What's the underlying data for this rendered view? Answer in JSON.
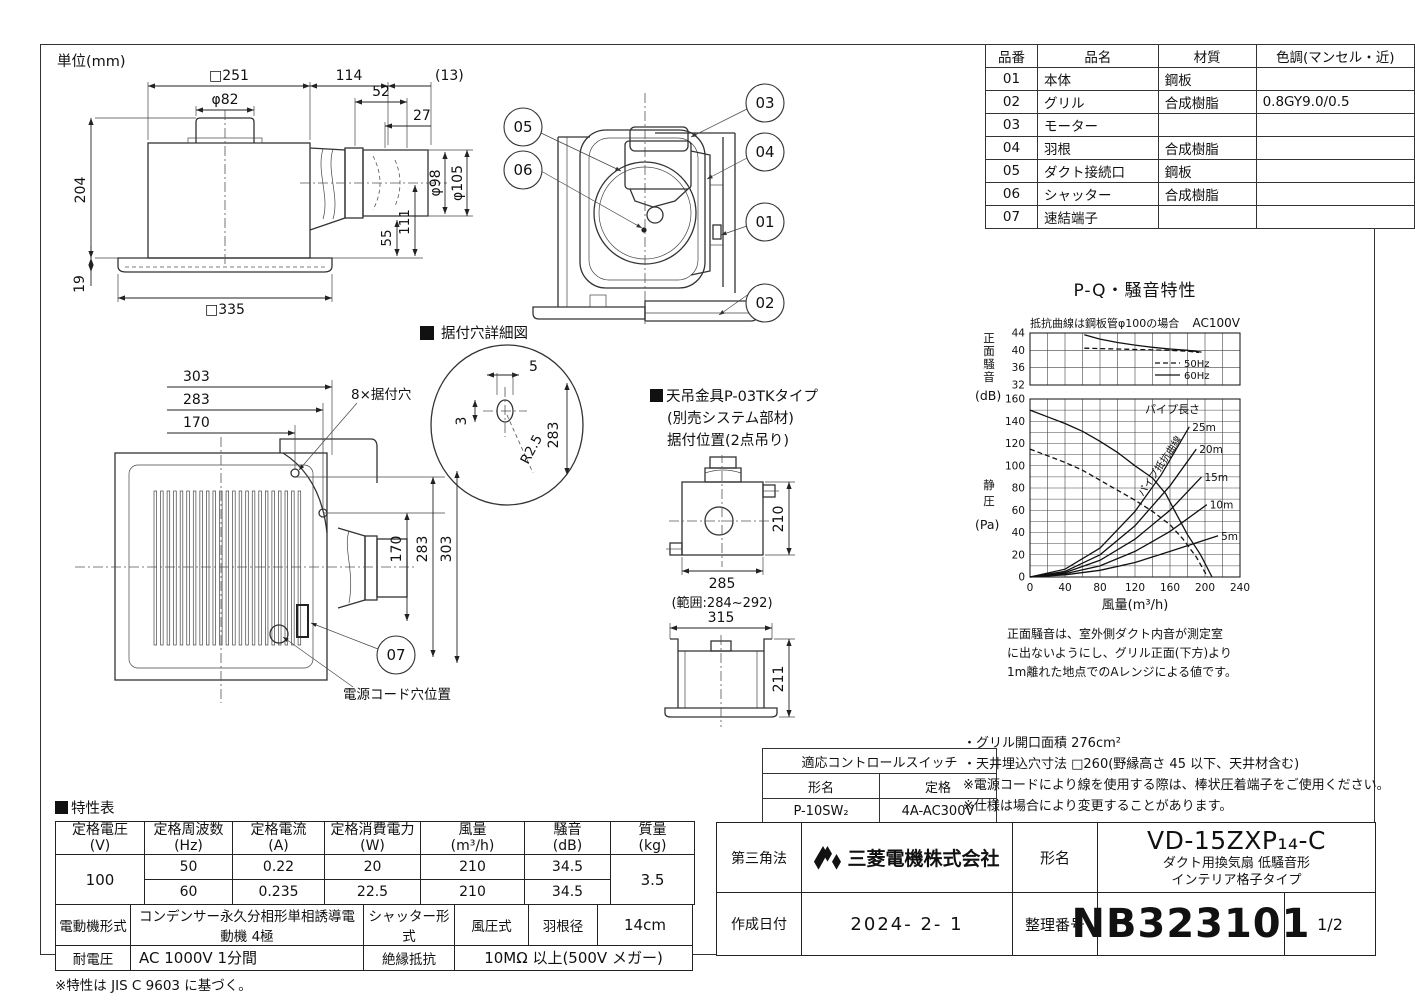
{
  "page": {
    "unit_label": "単位(mm)"
  },
  "side_view": {
    "dims": {
      "w251": "□251",
      "d114": "114",
      "d13": "(13)",
      "phi82": "φ82",
      "d52": "52",
      "d27": "27",
      "d204": "204",
      "phi98": "φ98",
      "phi105": "φ105",
      "d55": "55",
      "d111": "111",
      "d19": "19",
      "w335": "□335"
    }
  },
  "section_view": {
    "callouts": {
      "c01": "01",
      "c02": "02",
      "c03": "03",
      "c04": "04",
      "c05": "05",
      "c06": "06"
    }
  },
  "plan_view": {
    "detail_title": "据付穴詳細図",
    "dims": {
      "d303": "303",
      "d283": "283",
      "d170": "170",
      "v170": "170",
      "v283": "283",
      "v303": "303"
    },
    "labels": {
      "holes": "8×据付穴",
      "cord": "電源コード穴位置"
    },
    "callout07": "07",
    "detail": {
      "d5": "5",
      "d3": "3",
      "r": "R2.5",
      "d283": "283"
    }
  },
  "bracket": {
    "title1": "天吊金具P-03TKタイプ",
    "title2": "(別売システム部材)",
    "title3": "据付位置(2点吊り)",
    "dims": {
      "d210": "210",
      "d285": "285",
      "range": "(範囲:284~292)",
      "d315": "315",
      "d211": "211"
    }
  },
  "parts_table": {
    "headers": [
      "品番",
      "品名",
      "材質",
      "色調(マンセル・近)"
    ],
    "rows": [
      [
        "01",
        "本体",
        "鋼板",
        ""
      ],
      [
        "02",
        "グリル",
        "合成樹脂",
        "0.8GY9.0/0.5"
      ],
      [
        "03",
        "モーター",
        "",
        ""
      ],
      [
        "04",
        "羽根",
        "合成樹脂",
        ""
      ],
      [
        "05",
        "ダクト接続口",
        "鋼板",
        ""
      ],
      [
        "06",
        "シャッター",
        "合成樹脂",
        ""
      ],
      [
        "07",
        "速結端子",
        "",
        ""
      ]
    ]
  },
  "chart_data": [
    {
      "type": "line",
      "title": "P-Q・騒音特性",
      "subtitle_left": "抵抗曲線は鋼板管φ100の場合",
      "subtitle_right": "AC100V",
      "ylabel_vertical": "正面騒音",
      "ylabel_unit": "(dB)",
      "xlim": [
        0,
        240
      ],
      "ylim": [
        32,
        44
      ],
      "x_grid_step": 20,
      "y_grid_step": 4,
      "yticks": [
        44,
        40,
        36,
        32
      ],
      "grid": true,
      "legend_position": "inside bottom-right",
      "legend": [
        {
          "label": "50Hz",
          "style": "dashed"
        },
        {
          "label": "60Hz",
          "style": "solid"
        }
      ],
      "series": [
        {
          "name": "60Hz",
          "style": "solid",
          "points": [
            [
              62,
              43.6
            ],
            [
              80,
              42.6
            ],
            [
              100,
              41.8
            ],
            [
              120,
              41.2
            ],
            [
              140,
              40.7
            ],
            [
              160,
              40.3
            ],
            [
              180,
              40.0
            ],
            [
              196,
              39.6
            ]
          ]
        },
        {
          "name": "50Hz",
          "style": "dashed",
          "points": [
            [
              62,
              40.5
            ],
            [
              80,
              40.4
            ],
            [
              100,
              40.3
            ],
            [
              120,
              40.2
            ],
            [
              140,
              40.1
            ],
            [
              160,
              40.0
            ],
            [
              180,
              39.8
            ],
            [
              193,
              39.5
            ]
          ]
        }
      ]
    },
    {
      "type": "line",
      "ylabel_vertical": "静圧",
      "ylabel_unit": "(Pa)",
      "xlabel": "風量(m³/h)",
      "xlim": [
        0,
        240
      ],
      "ylim": [
        0,
        160
      ],
      "x_grid_step": 20,
      "y_grid_step": 10,
      "xticks": [
        0,
        40,
        80,
        120,
        160,
        200,
        240
      ],
      "yticks": [
        160,
        140,
        120,
        100,
        80,
        60,
        40,
        20,
        0
      ],
      "grid": true,
      "pipe_label_title": "パイプ長さ",
      "pipe_curve_label": "パイプ抵抗曲線",
      "series": [
        {
          "name": "60Hz fan curve",
          "style": "solid",
          "points": [
            [
              0,
              150
            ],
            [
              20,
              144
            ],
            [
              40,
              138
            ],
            [
              60,
              131
            ],
            [
              80,
              122
            ],
            [
              100,
              112
            ],
            [
              120,
              100
            ],
            [
              140,
              89
            ],
            [
              155,
              75
            ],
            [
              165,
              60
            ],
            [
              180,
              38
            ],
            [
              195,
              20
            ],
            [
              208,
              0
            ]
          ]
        },
        {
          "name": "50Hz fan curve",
          "style": "dashed",
          "points": [
            [
              0,
              115
            ],
            [
              20,
              109
            ],
            [
              40,
              103
            ],
            [
              60,
              96
            ],
            [
              80,
              87
            ],
            [
              100,
              78
            ],
            [
              120,
              69
            ],
            [
              140,
              59
            ],
            [
              160,
              47
            ],
            [
              175,
              34
            ],
            [
              190,
              18
            ],
            [
              203,
              0
            ]
          ]
        },
        {
          "name": "pipe 25m",
          "label": "25m",
          "style": "solid",
          "points": [
            [
              0,
              0
            ],
            [
              40,
              7
            ],
            [
              80,
              26
            ],
            [
              120,
              59
            ],
            [
              150,
              92
            ],
            [
              182,
              135
            ]
          ]
        },
        {
          "name": "pipe 20m",
          "label": "20m",
          "style": "solid",
          "points": [
            [
              0,
              0
            ],
            [
              40,
              5
            ],
            [
              80,
              20
            ],
            [
              120,
              46
            ],
            [
              160,
              82
            ],
            [
              190,
              115
            ]
          ]
        },
        {
          "name": "pipe 15m",
          "label": "15m",
          "style": "solid",
          "points": [
            [
              0,
              0
            ],
            [
              40,
              4
            ],
            [
              80,
              15
            ],
            [
              120,
              34
            ],
            [
              160,
              60
            ],
            [
              196,
              90
            ]
          ]
        },
        {
          "name": "pipe 10m",
          "label": "10m",
          "style": "solid",
          "points": [
            [
              0,
              0
            ],
            [
              40,
              3
            ],
            [
              80,
              10
            ],
            [
              120,
              23
            ],
            [
              160,
              41
            ],
            [
              202,
              65
            ]
          ]
        },
        {
          "name": "pipe 5m",
          "label": "5m",
          "style": "solid",
          "points": [
            [
              0,
              0
            ],
            [
              40,
              2
            ],
            [
              80,
              6
            ],
            [
              120,
              13
            ],
            [
              160,
              23
            ],
            [
              215,
              37
            ]
          ]
        }
      ],
      "footnote_lines": [
        "正面騒音は、室外側ダクト内音が測定室",
        "に出ないようにし、グリル正面(下方)より",
        "1m離れた地点でのAレンジによる値です。"
      ]
    }
  ],
  "control_switch": {
    "title": "適応コントロールスイッチ",
    "col1": "形名",
    "col2": "定格",
    "model": "P-10SW₂",
    "rating": "4A-AC300V"
  },
  "notes": [
    "・グリル開口面積 276cm²",
    "・天井埋込穴寸法 □260(野縁高さ 45 以下、天井材含む)",
    "※電源コードにより線を使用する際は、棒状圧着端子をご使用ください。",
    "※仕様は場合により変更することがあります。"
  ],
  "spec_table": {
    "title": "特性表",
    "headers": [
      [
        "定格電圧",
        "(V)"
      ],
      [
        "定格周波数",
        "(Hz)"
      ],
      [
        "定格電流",
        "(A)"
      ],
      [
        "定格消費電力",
        "(W)"
      ],
      [
        "風量",
        "(m³/h)"
      ],
      [
        "騒音",
        "(dB)"
      ],
      [
        "質量",
        "(kg)"
      ]
    ],
    "voltage": "100",
    "rows": [
      [
        "50",
        "0.22",
        "20",
        "210",
        "34.5"
      ],
      [
        "60",
        "0.235",
        "22.5",
        "210",
        "34.5"
      ]
    ],
    "mass": "3.5",
    "motor_label": "電動機形式",
    "motor": "コンデンサー永久分相形単相誘導電動機 4極",
    "shutter_label": "シャッター形式",
    "shutter": "風圧式",
    "blade_label": "羽根径",
    "blade": "14cm",
    "withstand_label": "耐電圧",
    "withstand": "AC 1000V 1分間",
    "insulation_label": "絶縁抵抗",
    "insulation": "10MΩ 以上(500V メガー)",
    "note": "※特性は JIS C 9603 に基づく。"
  },
  "title_block": {
    "projection": "第三角法",
    "company": "三菱電機株式会社",
    "model_label": "形名",
    "model": "VD-15ZXP₁₄-C",
    "model_desc1": "ダクト用換気扇 低騒音形",
    "model_desc2": "インテリア格子タイプ",
    "date_label": "作成日付",
    "date": "2024- 2- 1",
    "doc_label": "整理番号",
    "doc_number": "NB323101",
    "page": "1/2"
  }
}
